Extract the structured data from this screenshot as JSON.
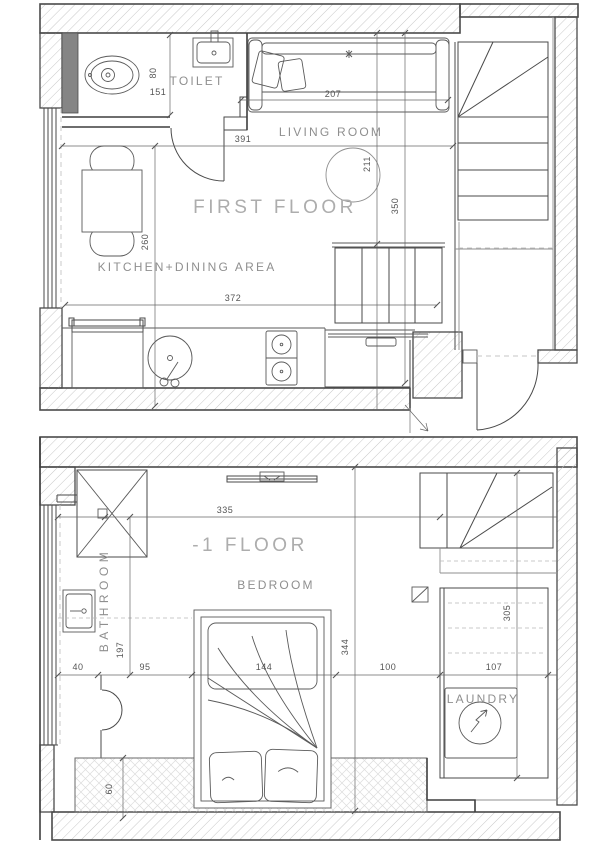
{
  "first_floor": {
    "title": "FIRST FLOOR",
    "labels": {
      "toilet": "TOILET",
      "living_room": "LIVING ROOM",
      "kitchen": "KITCHEN+DINING AREA"
    },
    "dims": {
      "d80": "80",
      "d151": "151",
      "d207": "207",
      "d391": "391",
      "d211": "211",
      "d350": "350",
      "d260": "260",
      "d372": "372"
    }
  },
  "lower_floor": {
    "title": "-1 FLOOR",
    "labels": {
      "bathroom": "BATHROOM",
      "bedroom": "BEDROOM",
      "laundry": "LAUNDRY"
    },
    "dims": {
      "d335": "335",
      "d40": "40",
      "d95": "95",
      "d144": "144",
      "d100": "100",
      "d107": "107",
      "d197": "197",
      "d344": "344",
      "d305": "305",
      "d60": "60"
    }
  },
  "colors": {
    "line": "#4a4a4a",
    "hatch": "#c8c8c8",
    "dim_text": "#555555",
    "room_label": "#8f8f8f",
    "floor_title": "#adadad"
  }
}
